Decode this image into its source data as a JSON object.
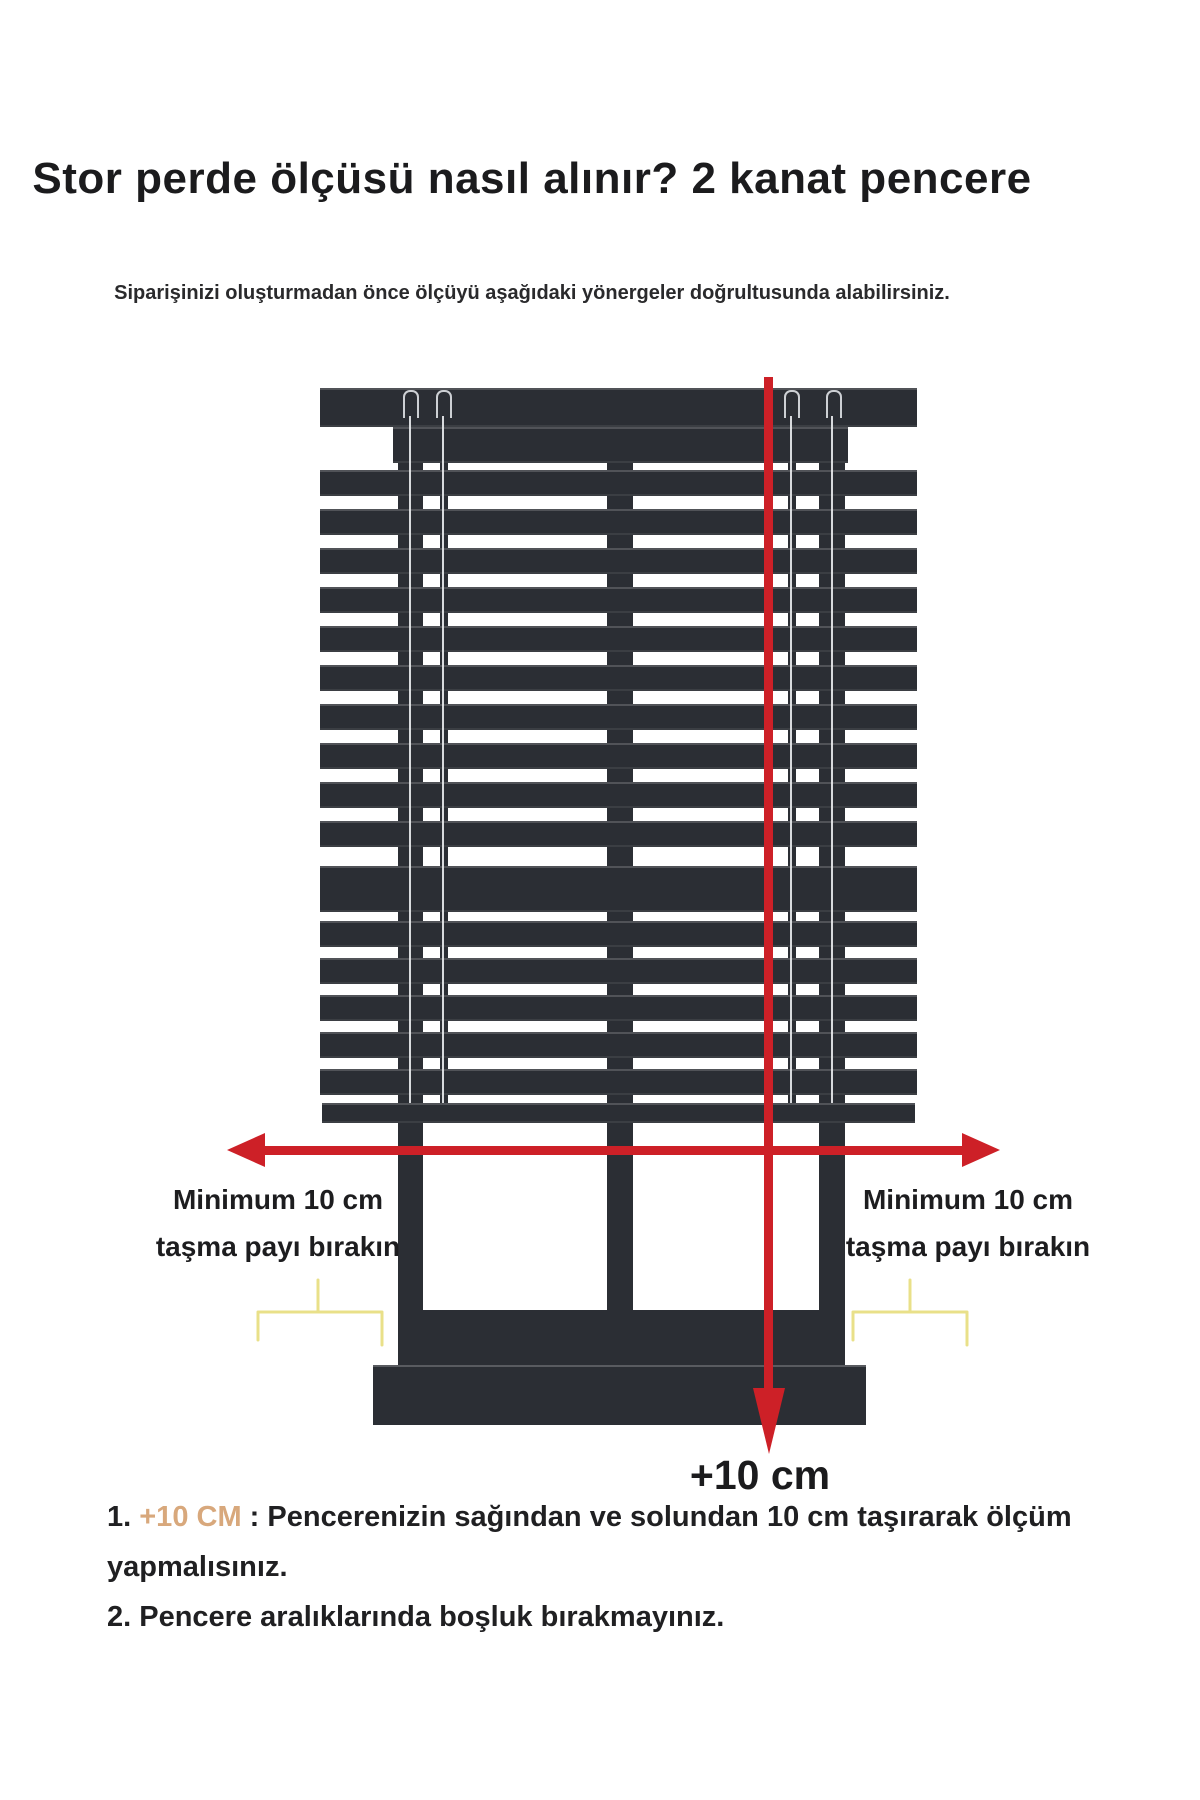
{
  "page": {
    "title": "Stor perde ölçüsü nasıl alınır? 2 kanat pencere",
    "subtitle": "Siparişinizi oluşturmadan önce ölçüyü aşağıdaki yönergeler doğrultusunda alabilirsiniz."
  },
  "diagram": {
    "left_label_line1": "Minimum 10 cm",
    "left_label_line2": "taşma payı bırakın",
    "right_label_line1": "Minimum 10 cm",
    "right_label_line2": "taşma payı bırakın",
    "bottom_measure_label": "+10 cm"
  },
  "instructions": {
    "item1_number": "1. ",
    "item1_highlight": "+10 CM",
    "item1_text": " : Pencerenizin sağından ve solundan 10 cm taşırarak ölçüm yapmalısınız.",
    "item2": "2. Pencere aralıklarında boşluk bırakmayınız."
  },
  "colors": {
    "frame": "#2b2e34",
    "arrow_red": "#cd2027",
    "bracket_yellow": "#e9e089",
    "text": "#1c1c1e",
    "highlight_orange": "#d8a87c"
  }
}
